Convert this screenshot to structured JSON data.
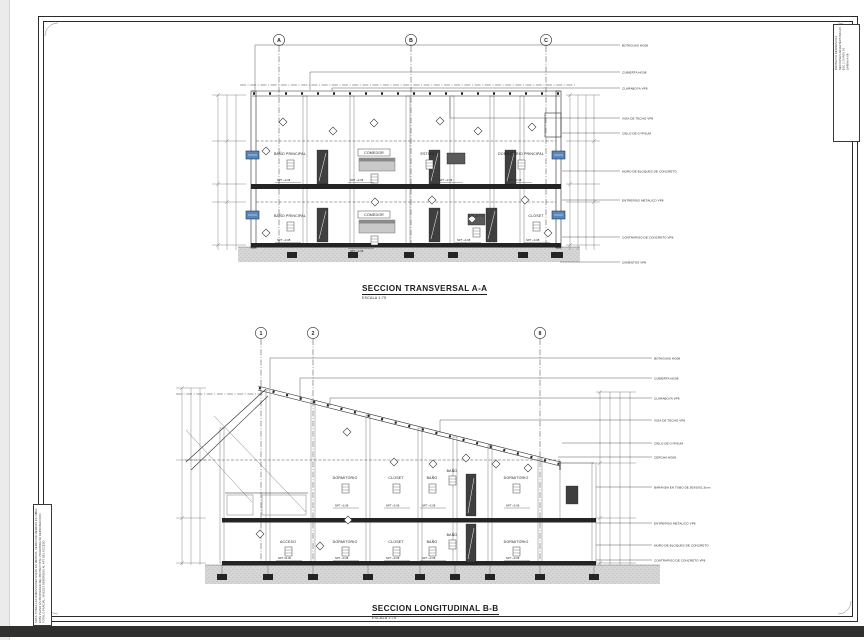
{
  "sheet": {
    "paper_color": "#ffffff",
    "line_color": "#2a2a2a",
    "window_color": "#5b87b8",
    "ground_color": "#d7d7d7",
    "bottom_bar_color": "#30312f"
  },
  "titleblock_right": {
    "text": "PROYECTO RESIDENCIAL\nSECCIONES ARQUITECTONICAS\nESC 1:75  REV 01\nLAMINA A-08"
  },
  "notes_left": {
    "text": "NOTA: TODAS LAS DIMENSIONES ESTAN EN METROS. VERIFICAR MEDIDAS EN OBRA. ESTE PLANO ES PROPIEDAD DEL PROYECTISTA. PROHIBIDA SU REPRODUCCION TOTAL O PARCIAL. NIVELES REFERIDOS AL NPT DEL ACCESO."
  },
  "transversal": {
    "title": "SECCION TRANSVERSAL A-A",
    "scale": "ESCALA 1:75",
    "grids": [
      "A",
      "B",
      "C"
    ],
    "upper_rooms": [
      {
        "name": "BAÑO PRINCIPAL",
        "npt": "NPT +3.08"
      },
      {
        "name": "COMEDOR",
        "npt": "NPT +3.08"
      },
      {
        "name": "ESTUDIO",
        "npt": "NPT +3.08"
      },
      {
        "name": "DORMITORIO PRINCIPAL",
        "npt": "NPT +3.08"
      }
    ],
    "lower_rooms": [
      {
        "name": "BAÑO PRINCIPAL",
        "npt": "NPT +0.08"
      },
      {
        "name": "COMEDOR",
        "npt": "NPT +0.08"
      },
      {
        "name": "SALA TV",
        "npt": "NPT +0.08"
      },
      {
        "name": "CLOSET",
        "npt": "NPT +0.08"
      }
    ],
    "annotations": [
      "BOTAGUAS HG08",
      "CUBIERTA HG08",
      "CLARABOYA VP8",
      "VIGA DE TECHO VP8",
      "CIELO DE GYPSUM",
      "MURO DE BLOQUES DE CONCRETO",
      "ENTREPISO METALICO VP8",
      "CONTRAPISO DE CONCRETO VP8",
      "CIMIENTOS VP8"
    ]
  },
  "longitudinal": {
    "title": "SECCION LONGITUDINAL B-B",
    "scale": "ESCALA 1:75",
    "grids": [
      "1",
      "2",
      "8"
    ],
    "upper_rooms": [
      {
        "name": "DORMITORIO",
        "npt": "NPT +3.08"
      },
      {
        "name": "CLOSET",
        "npt": "NPT +3.08"
      },
      {
        "name": "BAÑO",
        "npt": "NPT +3.08"
      },
      {
        "name": "BAÑO",
        "npt": "NPT +3.08"
      },
      {
        "name": "DORMITORIO",
        "npt": "NPT +3.08"
      }
    ],
    "lower_rooms": [
      {
        "name": "ACCESO",
        "npt": "NPT ±0.00"
      },
      {
        "name": "DORMITORIO",
        "npt": "NPT +0.08"
      },
      {
        "name": "CLOSET",
        "npt": "NPT +0.08"
      },
      {
        "name": "BAÑO",
        "npt": "NPT +0.08"
      },
      {
        "name": "BAÑO",
        "npt": "NPT +0.08"
      },
      {
        "name": "DORMITORIO",
        "npt": "NPT +0.08"
      }
    ],
    "annotations": [
      "BOTAGUAS HG08",
      "CUBIERTA HG08",
      "CLARABOYA VP8",
      "VIGA DE TECHO VP8",
      "CIELO DE GYPSUM",
      "CERCHA HG08",
      "BARANDA EN TUBO DE 50X50X1.5mm",
      "ENTREPISO METALICO VP8",
      "MURO DE BLOQUES DE CONCRETO",
      "CONTRAPISO DE CONCRETO VP8"
    ]
  }
}
